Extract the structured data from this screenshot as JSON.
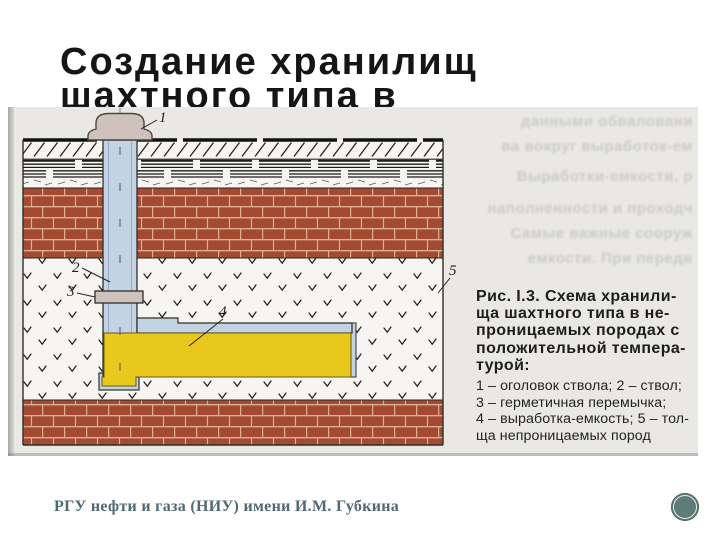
{
  "slide": {
    "title_line1": "Создание хранилищ",
    "title_line2": "шахтного типа в",
    "footer": "РГУ нефти и газа (НИУ) имени И.М. Губкина"
  },
  "figure": {
    "labels": {
      "head": "1",
      "shaft": "2",
      "seal": "3",
      "chamber": "4",
      "rock": "5"
    },
    "caption_heading": [
      "Рис. I.3. Схема хранили-",
      "ща шахтного типа в не-",
      "проницаемых породах с",
      "положительной темпера-",
      "турой:"
    ],
    "caption_legend": [
      "1 – оголовок ствола; 2 – ствол;",
      "3 – герметичная перемычка;",
      "4 – выработка-емкость; 5 – тол-",
      "ща непроницаемых пород"
    ],
    "bleedthrough": [
      "данными обваловани",
      "ва вокруг выработок-ем",
      "Выработки-емкости, р",
      "наполненности и проходч",
      "Самые важные сооруж",
      "емкости. При передв"
    ],
    "colors": {
      "brick": "#a34a31",
      "mortar": "#dcb097",
      "shaft_blue": "#c3d3e4",
      "storage_yellow": "#e9c81e",
      "head_gray": "#cfc1bb",
      "page_gray": "#e9e8e4",
      "circle_teal": "#5e7b78"
    }
  }
}
